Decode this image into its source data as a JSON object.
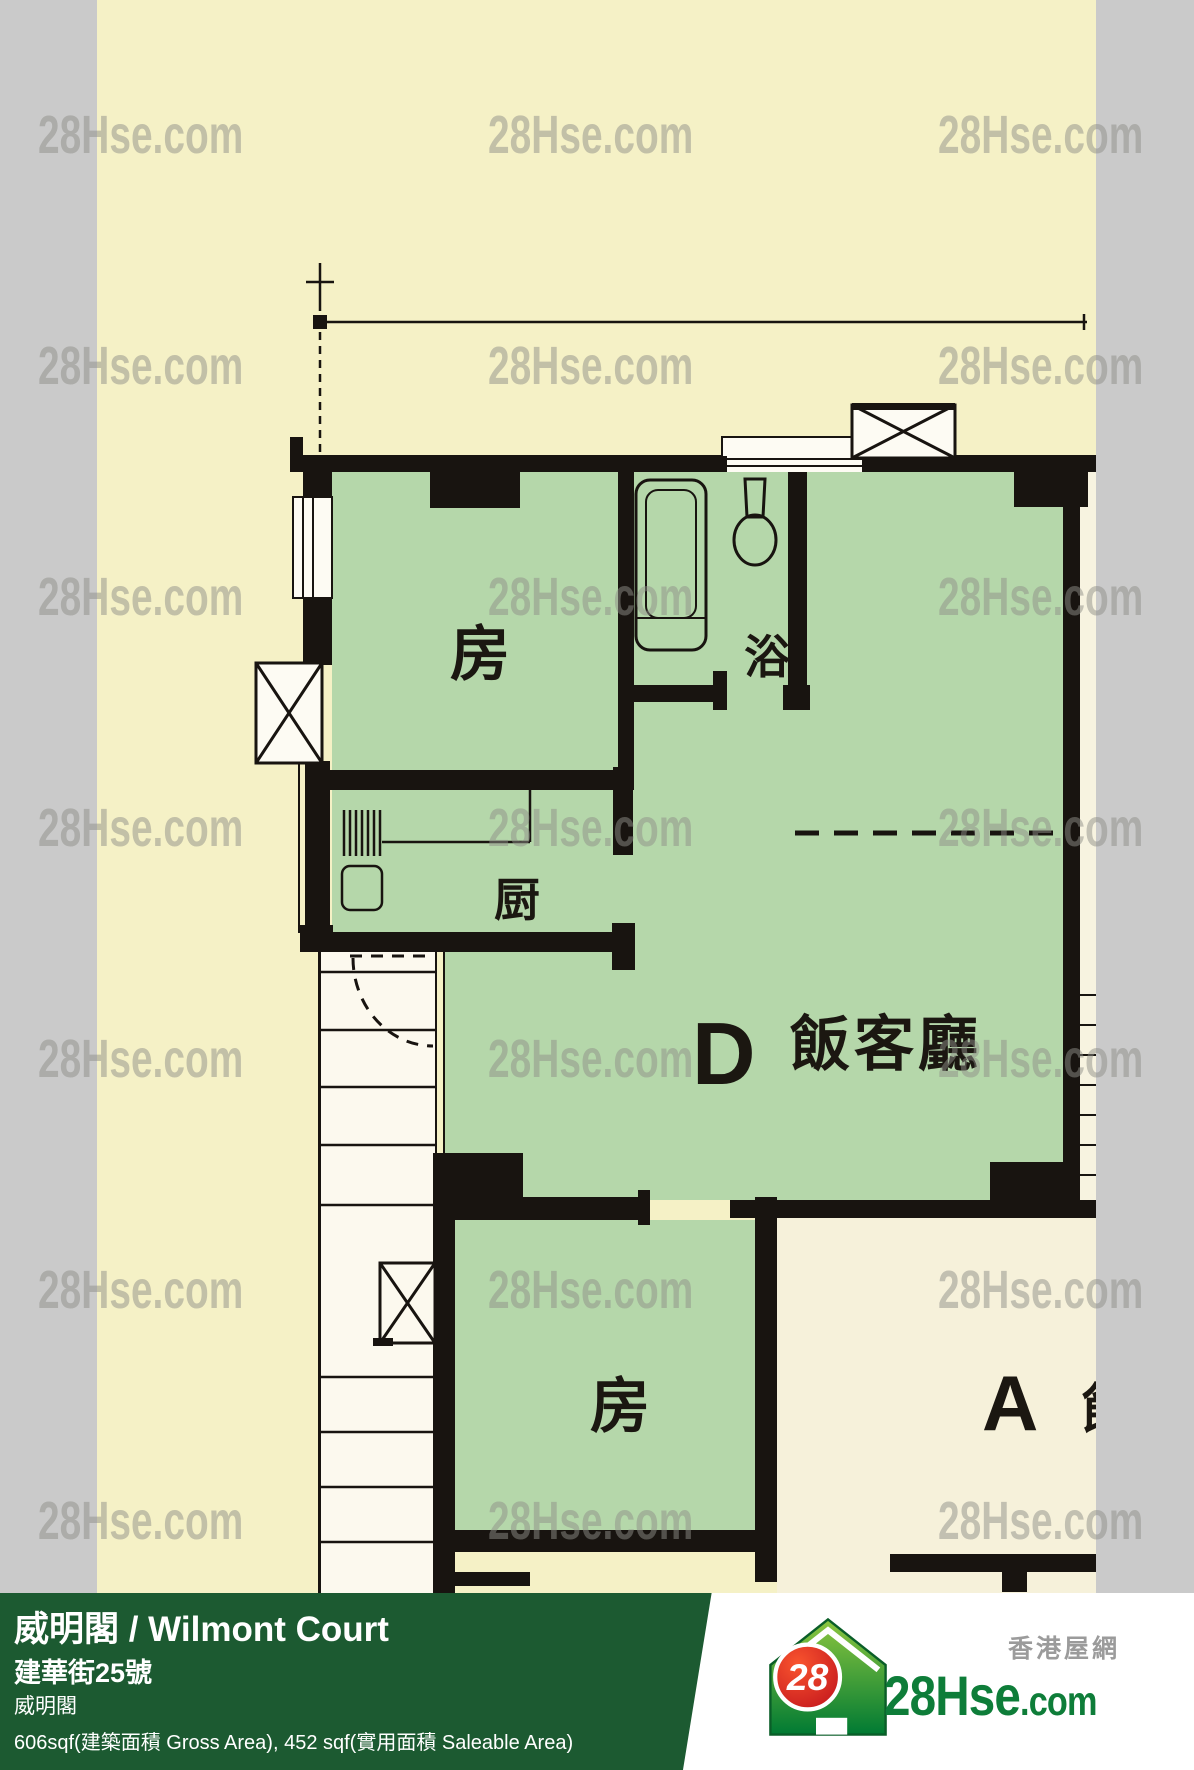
{
  "plan": {
    "watermark": "28Hse.com",
    "rooms": {
      "bedroom1": "房",
      "bath": "浴",
      "kitchen": "厨",
      "living_unit_letter": "D",
      "living": "飯客廳",
      "bedroom2": "房",
      "unit_a_letter": "A",
      "unit_a_partial": "飯"
    }
  },
  "footer": {
    "title": "威明閣 / Wilmont Court",
    "address": "建華街25號",
    "estate": "威明閣",
    "area": "606sqf(建築面積 Gross Area), 452 sqf(實用面積 Saleable Area)"
  },
  "logo": {
    "badge": "28",
    "brand": "28Hse",
    "brand_suffix": ".com",
    "tagline": "香港屋網"
  },
  "colors": {
    "background_cream": "#f5f1c6",
    "room_green": "#b5d7aa",
    "unit_a_cream": "#f6f1da",
    "wall_black": "#181410",
    "edge_gray": "#cacaca",
    "watermark_gray": "#8f8f89",
    "footer_green": "#1c5a31",
    "logo_green": "#0e7d39",
    "logo_red": "#e01b22"
  }
}
